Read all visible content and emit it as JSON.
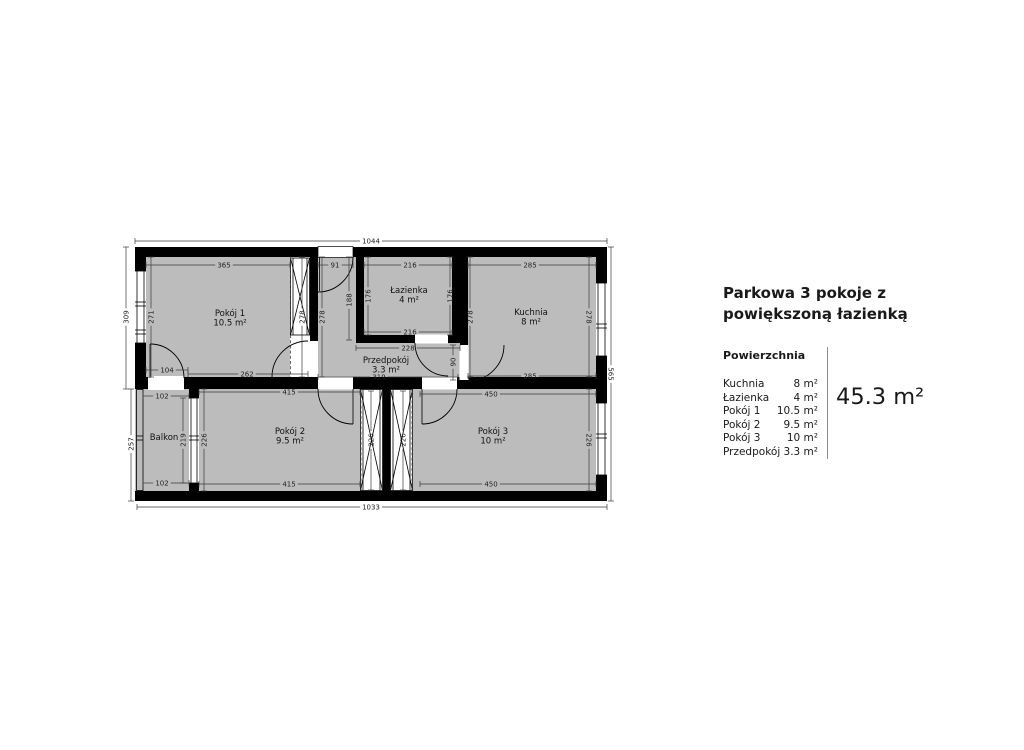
{
  "panel": {
    "title": "Parkowa 3 pokoje z powiększoną łazienką",
    "section_label": "Powierzchnia",
    "areas": [
      {
        "name": "Kuchnia",
        "value": "8 m²"
      },
      {
        "name": "Łazienka",
        "value": "4 m²"
      },
      {
        "name": "Pokój 1",
        "value": "10.5 m²"
      },
      {
        "name": "Pokój 2",
        "value": "9.5 m²"
      },
      {
        "name": "Pokój 3",
        "value": "10 m²"
      },
      {
        "name": "Przedpokój",
        "value": "3.3 m²"
      }
    ],
    "total": "45.3 m²"
  },
  "floorplan": {
    "floor_color": "#bcbcbc",
    "wall_color": "#000000",
    "rooms": [
      {
        "name": "Pokój 1",
        "area": "10.5 m²",
        "x": 230,
        "y": 316
      },
      {
        "name": "Łazienka",
        "area": "4 m²",
        "x": 409,
        "y": 293
      },
      {
        "name": "Kuchnia",
        "area": "8 m²",
        "x": 531,
        "y": 315
      },
      {
        "name": "Przedpokój",
        "area": "3.3 m²",
        "x": 386,
        "y": 363
      },
      {
        "name": "Balkon",
        "area": "",
        "x": 164,
        "y": 440
      },
      {
        "name": "Pokój 2",
        "area": "9.5 m²",
        "x": 290,
        "y": 434
      },
      {
        "name": "Pokój 3",
        "area": "10 m²",
        "x": 493,
        "y": 434
      }
    ],
    "dimensions": [
      {
        "label": "1044",
        "o": "h",
        "x": 371,
        "y": 241,
        "a": 135,
        "b": 607
      },
      {
        "label": "365",
        "o": "h",
        "x": 224,
        "y": 265,
        "a": 146,
        "b": 290
      },
      {
        "label": "91",
        "o": "h",
        "x": 335,
        "y": 265,
        "a": 318,
        "b": 353
      },
      {
        "label": "216",
        "o": "h",
        "x": 410,
        "y": 265,
        "a": 364,
        "b": 452
      },
      {
        "label": "285",
        "o": "h",
        "x": 530,
        "y": 265,
        "a": 468,
        "b": 596
      },
      {
        "label": "216",
        "o": "h",
        "x": 410,
        "y": 332,
        "a": 364,
        "b": 452
      },
      {
        "label": "228",
        "o": "h",
        "x": 408,
        "y": 348,
        "a": 356,
        "b": 460
      },
      {
        "label": "104",
        "o": "h",
        "x": 167,
        "y": 370,
        "a": 146,
        "b": 188
      },
      {
        "label": "262",
        "o": "h",
        "x": 247,
        "y": 374,
        "a": 188,
        "b": 308
      },
      {
        "label": "319",
        "o": "h",
        "x": 379,
        "y": 377,
        "a": 318,
        "b": 458
      },
      {
        "label": "285",
        "o": "h",
        "x": 530,
        "y": 376,
        "a": 468,
        "b": 596
      },
      {
        "label": "102",
        "o": "h",
        "x": 162,
        "y": 396,
        "a": 143,
        "b": 189
      },
      {
        "label": "415",
        "o": "h",
        "x": 289,
        "y": 392,
        "a": 199,
        "b": 360
      },
      {
        "label": "450",
        "o": "h",
        "x": 491,
        "y": 394,
        "a": 420,
        "b": 596
      },
      {
        "label": "102",
        "o": "h",
        "x": 162,
        "y": 483,
        "a": 143,
        "b": 189
      },
      {
        "label": "415",
        "o": "h",
        "x": 289,
        "y": 484,
        "a": 199,
        "b": 360
      },
      {
        "label": "450",
        "o": "h",
        "x": 491,
        "y": 484,
        "a": 420,
        "b": 596
      },
      {
        "label": "1033",
        "o": "h",
        "x": 371,
        "y": 507,
        "a": 137,
        "b": 607
      },
      {
        "label": "309",
        "o": "v",
        "x": 126,
        "y": 317,
        "a": 247,
        "b": 389
      },
      {
        "label": "257",
        "o": "v",
        "x": 131,
        "y": 444,
        "a": 389,
        "b": 501
      },
      {
        "label": "271",
        "o": "v",
        "x": 151,
        "y": 317,
        "a": 257,
        "b": 377
      },
      {
        "label": "278",
        "o": "v",
        "x": 302,
        "y": 317,
        "a": 257,
        "b": 377
      },
      {
        "label": "278",
        "o": "v",
        "x": 322,
        "y": 317,
        "a": 257,
        "b": 377
      },
      {
        "label": "188",
        "o": "v",
        "x": 349,
        "y": 300,
        "a": 257,
        "b": 340
      },
      {
        "label": "176",
        "o": "v",
        "x": 368,
        "y": 296,
        "a": 257,
        "b": 335
      },
      {
        "label": "176",
        "o": "v",
        "x": 450,
        "y": 296,
        "a": 257,
        "b": 335
      },
      {
        "label": "278",
        "o": "v",
        "x": 470,
        "y": 317,
        "a": 257,
        "b": 377
      },
      {
        "label": "278",
        "o": "v",
        "x": 589,
        "y": 317,
        "a": 257,
        "b": 377,
        "flip": true
      },
      {
        "label": "90",
        "o": "v",
        "x": 453,
        "y": 362,
        "a": 345,
        "b": 380
      },
      {
        "label": "565",
        "o": "v",
        "x": 611,
        "y": 374,
        "a": 247,
        "b": 501,
        "flip": true
      },
      {
        "label": "219",
        "o": "v",
        "x": 183,
        "y": 440,
        "a": 398,
        "b": 483
      },
      {
        "label": "226",
        "o": "v",
        "x": 204,
        "y": 440,
        "a": 389,
        "b": 491
      },
      {
        "label": "226",
        "o": "v",
        "x": 371,
        "y": 440,
        "a": 391,
        "b": 490
      },
      {
        "label": "226",
        "o": "v",
        "x": 403,
        "y": 440,
        "a": 391,
        "b": 490
      },
      {
        "label": "226",
        "o": "v",
        "x": 589,
        "y": 440,
        "a": 389,
        "b": 491,
        "flip": true
      }
    ]
  }
}
